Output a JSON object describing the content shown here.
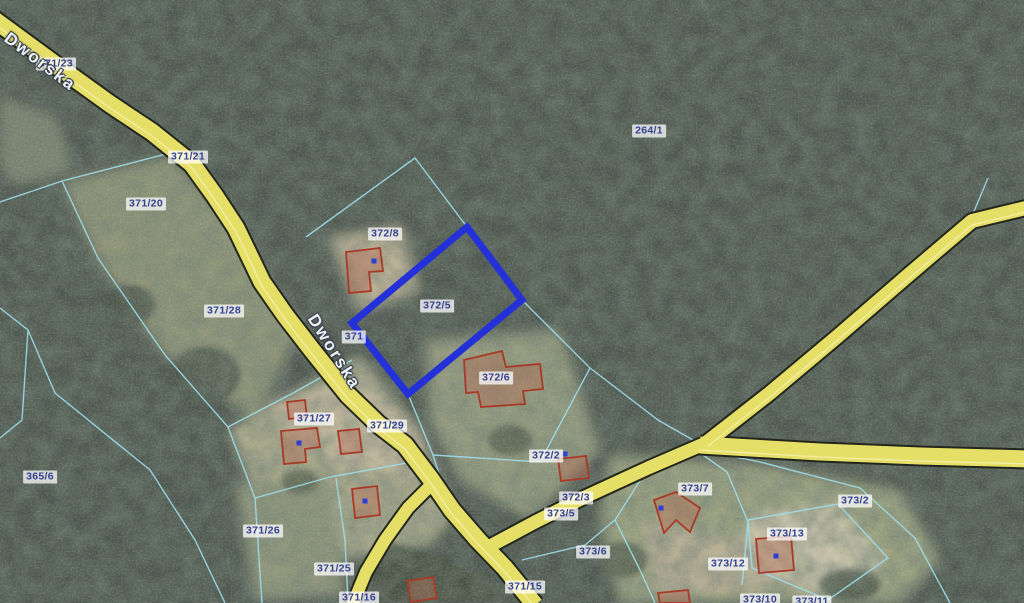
{
  "map": {
    "description": "cadastral parcel overlay on satellite imagery",
    "street_labels": [
      {
        "name": "Dworska",
        "x": 40,
        "y": 62,
        "angle": 37
      },
      {
        "name": "Dworska",
        "x": 334,
        "y": 352,
        "angle": 58
      }
    ],
    "parcel_labels": [
      {
        "id": "371/23",
        "x": 56,
        "y": 64
      },
      {
        "id": "371/21",
        "x": 188,
        "y": 157
      },
      {
        "id": "371/20",
        "x": 146,
        "y": 204
      },
      {
        "id": "264/1",
        "x": 649,
        "y": 131
      },
      {
        "id": "372/8",
        "x": 385,
        "y": 234
      },
      {
        "id": "372/5",
        "x": 437,
        "y": 306
      },
      {
        "id": "371/28",
        "x": 224,
        "y": 311
      },
      {
        "id": "371",
        "x": 354,
        "y": 337
      },
      {
        "id": "372/6",
        "x": 496,
        "y": 378
      },
      {
        "id": "371/27",
        "x": 314,
        "y": 419
      },
      {
        "id": "371/29",
        "x": 387,
        "y": 426
      },
      {
        "id": "365/6",
        "x": 40,
        "y": 477
      },
      {
        "id": "372/2",
        "x": 546,
        "y": 456
      },
      {
        "id": "372/3",
        "x": 576,
        "y": 498
      },
      {
        "id": "373/7",
        "x": 695,
        "y": 489
      },
      {
        "id": "373/2",
        "x": 855,
        "y": 501
      },
      {
        "id": "373/5",
        "x": 561,
        "y": 514
      },
      {
        "id": "371/26",
        "x": 263,
        "y": 531
      },
      {
        "id": "373/13",
        "x": 787,
        "y": 534
      },
      {
        "id": "373/6",
        "x": 593,
        "y": 552
      },
      {
        "id": "373/12",
        "x": 728,
        "y": 564
      },
      {
        "id": "371/25",
        "x": 334,
        "y": 569
      },
      {
        "id": "371/15",
        "x": 525,
        "y": 587
      },
      {
        "id": "371/16",
        "x": 359,
        "y": 598
      },
      {
        "id": "373/10",
        "x": 760,
        "y": 600
      },
      {
        "id": "373/11",
        "x": 812,
        "y": 602
      }
    ],
    "selected_parcel": {
      "id": "372/5",
      "outline_color": "#2531d8"
    },
    "colors": {
      "forest": "#515b51",
      "field": "#969c80",
      "road_fill": "#e6df67",
      "road_casing": "#23261d",
      "boundary_line": "#9fdde9",
      "building_outline": "#a83a28",
      "building_dot": "#2d3fd4",
      "label_text": "#33418f"
    }
  }
}
